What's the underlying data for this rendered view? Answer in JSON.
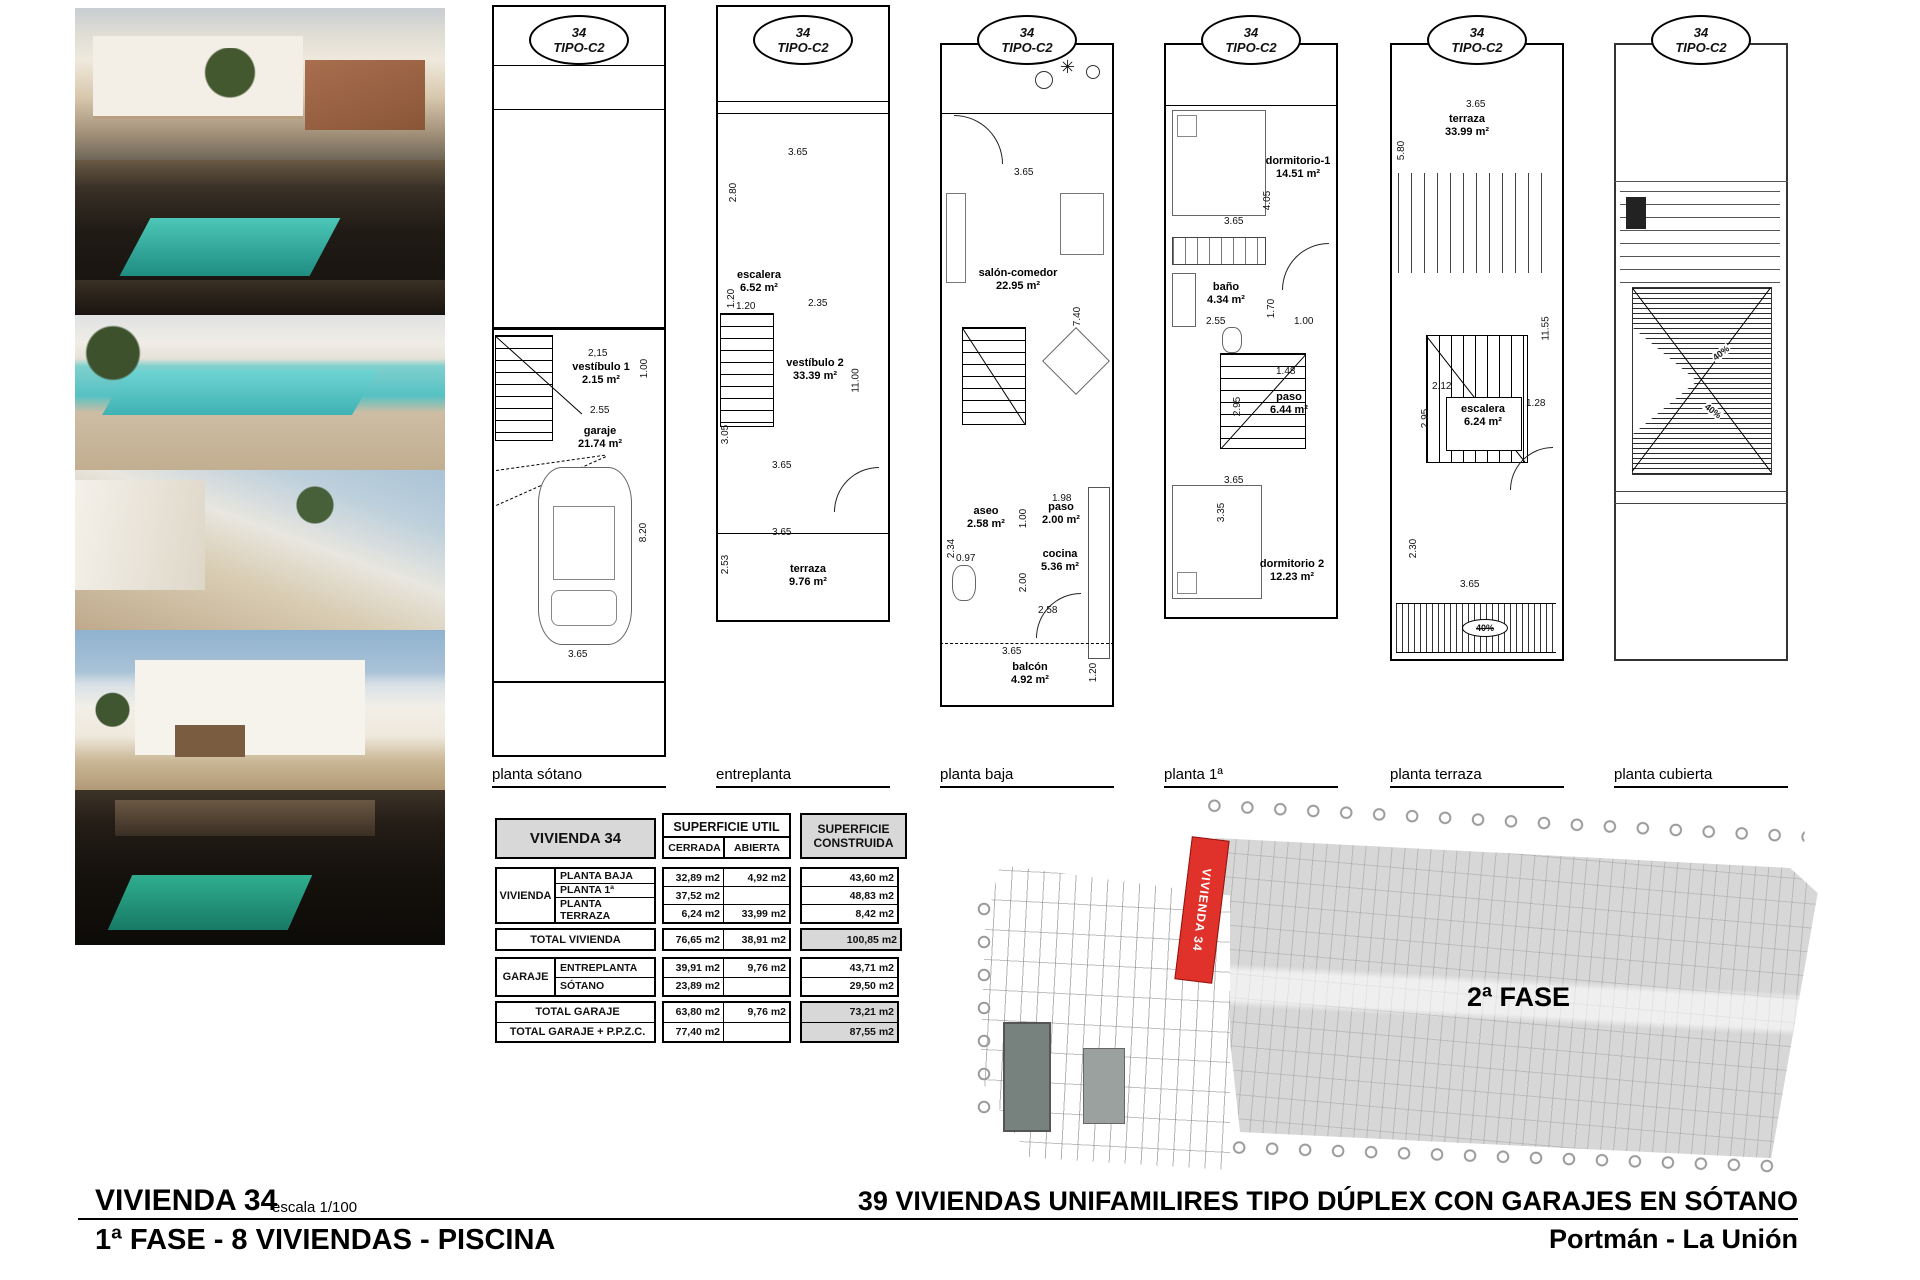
{
  "badge": {
    "number": "34",
    "type": "TIPO-C2"
  },
  "plans": [
    {
      "label": "planta sótano",
      "rooms": [
        {
          "name": "vestíbulo 1",
          "area": "2.15 m²"
        },
        {
          "name": "garaje",
          "area": "21.74 m²"
        }
      ],
      "dims": [
        "2,15",
        "1.00",
        "2.55",
        "8.20",
        "3.65"
      ]
    },
    {
      "label": "entreplanta",
      "rooms": [
        {
          "name": "escalera",
          "area": "6.52 m²"
        },
        {
          "name": "vestíbulo 2",
          "area": "33.39 m²"
        },
        {
          "name": "terraza",
          "area": "9.76 m²"
        }
      ],
      "dims": [
        "3.65",
        "2.80",
        "1.20",
        "1.20",
        "2.35",
        "11.00",
        "3.05",
        "3.65",
        "3.65",
        "2.53"
      ]
    },
    {
      "label": "planta baja",
      "rooms": [
        {
          "name": "salón-comedor",
          "area": "22.95 m²"
        },
        {
          "name": "aseo",
          "area": "2.58 m²"
        },
        {
          "name": "paso",
          "area": "2.00 m²"
        },
        {
          "name": "cocina",
          "area": "5.36 m²"
        },
        {
          "name": "balcón",
          "area": "4.92 m²"
        }
      ],
      "dims": [
        "3.65",
        "7.40",
        "1.98",
        "1.00",
        "2.34",
        "0.97",
        "2.00",
        "2.58",
        "3.65",
        "1.20"
      ]
    },
    {
      "label": "planta 1ª",
      "rooms": [
        {
          "name": "dormitorio-1",
          "area": "14.51 m²"
        },
        {
          "name": "baño",
          "area": "4.34 m²"
        },
        {
          "name": "paso",
          "area": "6.44 m²"
        },
        {
          "name": "dormitorio 2",
          "area": "12.23 m²"
        }
      ],
      "dims": [
        "4.05",
        "3.65",
        "1.70",
        "2.55",
        "1.00",
        "1.48",
        "2.95",
        "3.65",
        "3.35"
      ]
    },
    {
      "label": "planta terraza",
      "rooms": [
        {
          "name": "terraza",
          "area": "33.99 m²"
        },
        {
          "name": "escalera",
          "area": "6.24 m²"
        }
      ],
      "dims": [
        "3.65",
        "5.80",
        "11.55",
        "2.12",
        "2.95",
        "1.28",
        "2.30",
        "3.65"
      ],
      "slope": "40%"
    },
    {
      "label": "planta cubierta",
      "rooms": [],
      "dims": [],
      "slope": "40%"
    }
  ],
  "table": {
    "title": "VIVIENDA 34",
    "col_util": "SUPERFICIE UTIL",
    "col_cerrada": "CERRADA",
    "col_abierta": "ABIERTA",
    "col_construida": "SUPERFICIE CONSTRUIDA",
    "group_vivienda": "VIVIENDA",
    "group_garaje": "GARAJE",
    "rows_vivienda": [
      {
        "name": "PLANTA BAJA",
        "cerrada": "32,89 m2",
        "abierta": "4,92 m2",
        "construida": "43,60 m2"
      },
      {
        "name": "PLANTA 1ª",
        "cerrada": "37,52 m2",
        "abierta": "",
        "construida": "48,83 m2"
      },
      {
        "name": "PLANTA TERRAZA",
        "cerrada": "6,24 m2",
        "abierta": "33,99 m2",
        "construida": "8,42 m2"
      }
    ],
    "total_vivienda": {
      "name": "TOTAL VIVIENDA",
      "cerrada": "76,65 m2",
      "abierta": "38,91 m2",
      "construida": "100,85 m2"
    },
    "rows_garaje": [
      {
        "name": "ENTREPLANTA",
        "cerrada": "39,91 m2",
        "abierta": "9,76 m2",
        "construida": "43,71 m2"
      },
      {
        "name": "SÓTANO",
        "cerrada": "23,89 m2",
        "abierta": "",
        "construida": "29,50 m2"
      }
    ],
    "total_garaje": {
      "name": "TOTAL GARAJE",
      "cerrada": "63,80 m2",
      "abierta": "9,76 m2",
      "construida": "73,21 m2"
    },
    "total_garaje_ppzc": {
      "name": "TOTAL GARAJE + P.P.Z.C.",
      "cerrada": "77,40 m2",
      "abierta": "",
      "construida": "87,55 m2"
    }
  },
  "siteplan": {
    "phase_label": "2ª FASE",
    "highlight_label": "VIVIENDA 34"
  },
  "titleblock": {
    "left_title": "VIVIENDA 34",
    "left_scale": "escala 1/100",
    "left_subtitle": "1ª FASE - 8 VIVIENDAS - PISCINA",
    "right_title": "39 VIVIENDAS UNIFAMILIRES TIPO DÚPLEX CON GARAJES EN SÓTANO",
    "right_subtitle": "Portmán - La Unión"
  }
}
